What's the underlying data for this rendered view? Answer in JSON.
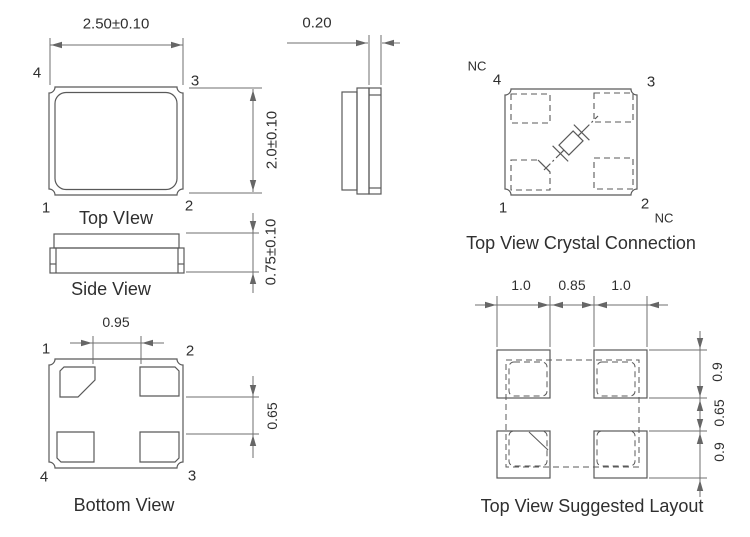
{
  "colors": {
    "line": "#595959",
    "dim_line": "#6f6f6f",
    "text": "#2f2f2f",
    "background": "#ffffff"
  },
  "top_view": {
    "caption": "Top VIew",
    "width_dim": "2.50±0.10",
    "height_dim": "2.0±0.10",
    "pin_tl": "4",
    "pin_tr": "3",
    "pin_bl": "1",
    "pin_br": "2"
  },
  "end_view": {
    "thickness_dim": "0.20"
  },
  "side_view": {
    "caption": "Side View",
    "height_dim": "0.75±0.10"
  },
  "bottom_view": {
    "caption": "Bottom View",
    "pad_gap_dim": "0.95",
    "pad_row_gap_dim": "0.65",
    "pin_tl": "1",
    "pin_tr": "2",
    "pin_bl": "4",
    "pin_br": "3"
  },
  "crystal_connection": {
    "caption": "Top View Crystal Connection",
    "pin_tl": "4",
    "pin_tr": "3",
    "pin_bl": "1",
    "pin_br": "2",
    "nc_top": "NC",
    "nc_bottom": "NC"
  },
  "suggested_layout": {
    "caption": "Top View Suggested Layout",
    "pad_width_left": "1.0",
    "pad_gap": "0.85",
    "pad_width_right": "1.0",
    "pad_height_top": "0.9",
    "row_gap": "0.65",
    "pad_height_bottom": "0.9"
  }
}
